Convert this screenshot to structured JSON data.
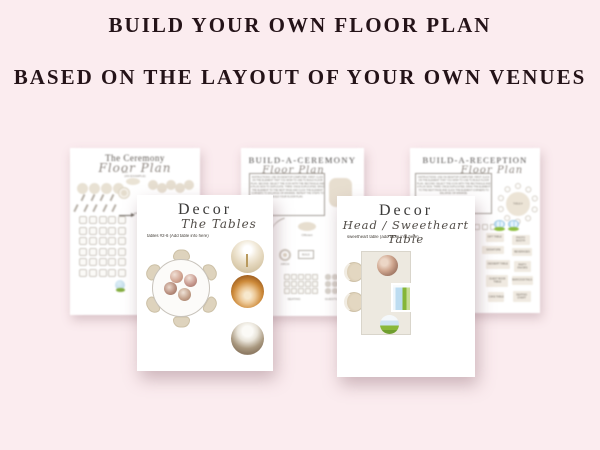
{
  "header": {
    "line1": "BUILD YOUR OWN FLOOR PLAN",
    "line2": "BASED ON THE LAYOUT OF YOUR OWN VENUES"
  },
  "colors": {
    "background": "#fbecef",
    "title_text": "#241318",
    "tan_furniture": "#e7decf",
    "accent_green": "#8ab83a",
    "accent_blue": "#bcdcf1"
  },
  "pages": {
    "ceremony": {
      "title": "The Ceremony",
      "subtitle": "Floor Plan",
      "note": "(AN EXAMPLE)",
      "arch_label": "arch",
      "aisle_label": "aisle"
    },
    "build_ceremony": {
      "title": "BUILD-A-CEREMONY",
      "subtitle": "Floor Plan",
      "instructions": "INSTRUCTIONS: USE ON DESKTOP COMPUTER. FIRST: CLICK ON THE ELEMENT THAT YOU WISH TO USE TO BUILD FLOOR PLAN. SECOND: SELECT THE ICON WITH THE RECTANGLE AND A PLUS SIGN TO DUPLICATE. THIRD: ONCE DUPLICATED, DRAG THE ELEMENT TO THE NEXT PAGE AND CLICK THE ELEMENT CORNERS TO ENLARGE OR MINIMIZE. REPEAT THE STEPS TO BUILD YOUR FLOOR PLAN.",
      "officiant_label": "Officiant",
      "arch_label": "ARCH",
      "button_label": "BUILD",
      "seating_label": "SEATING",
      "guests_label": "GUESTS"
    },
    "build_reception": {
      "title": "BUILD-A-RECEPTION",
      "subtitle": "Floor Plan",
      "instructions": "INSTRUCTIONS: USE ON DESKTOP COMPUTER. FIRST: CLICK ON THE ELEMENT THAT YOU WISH TO USE TO BUILD FLOOR PLAN. SECOND: SELECT THE ICON WITH THE RECTANGLE AND A PLUS SIGN. THIRD: ONCE DUPLICATED, DRAG THE ELEMENT TO THE NEXT PAGE AND CLICK THE ELEMENT CORNERS TO ENLARGE OR MINIMIZE.",
      "table_label": "TABLE #",
      "buttons": [
        "GIFT TABLE",
        "PHOTO BOOTH",
        "SIGNATURE",
        "BEVERAGES",
        "DESSERT TABLE",
        "PARTY FAVORS",
        "GUEST BOOK TABLE",
        "BAR/COCKTAILS",
        "CAKE TABLE",
        "SEATING CHART"
      ]
    },
    "decor_tables": {
      "title": "Decor",
      "subtitle": "The Tables",
      "note": "tables #2-6  (Add table info here)"
    },
    "decor_head": {
      "title": "Decor",
      "subtitle": "Head / Sweetheart Table",
      "note": "sweetheart table  (add table info here)"
    }
  }
}
